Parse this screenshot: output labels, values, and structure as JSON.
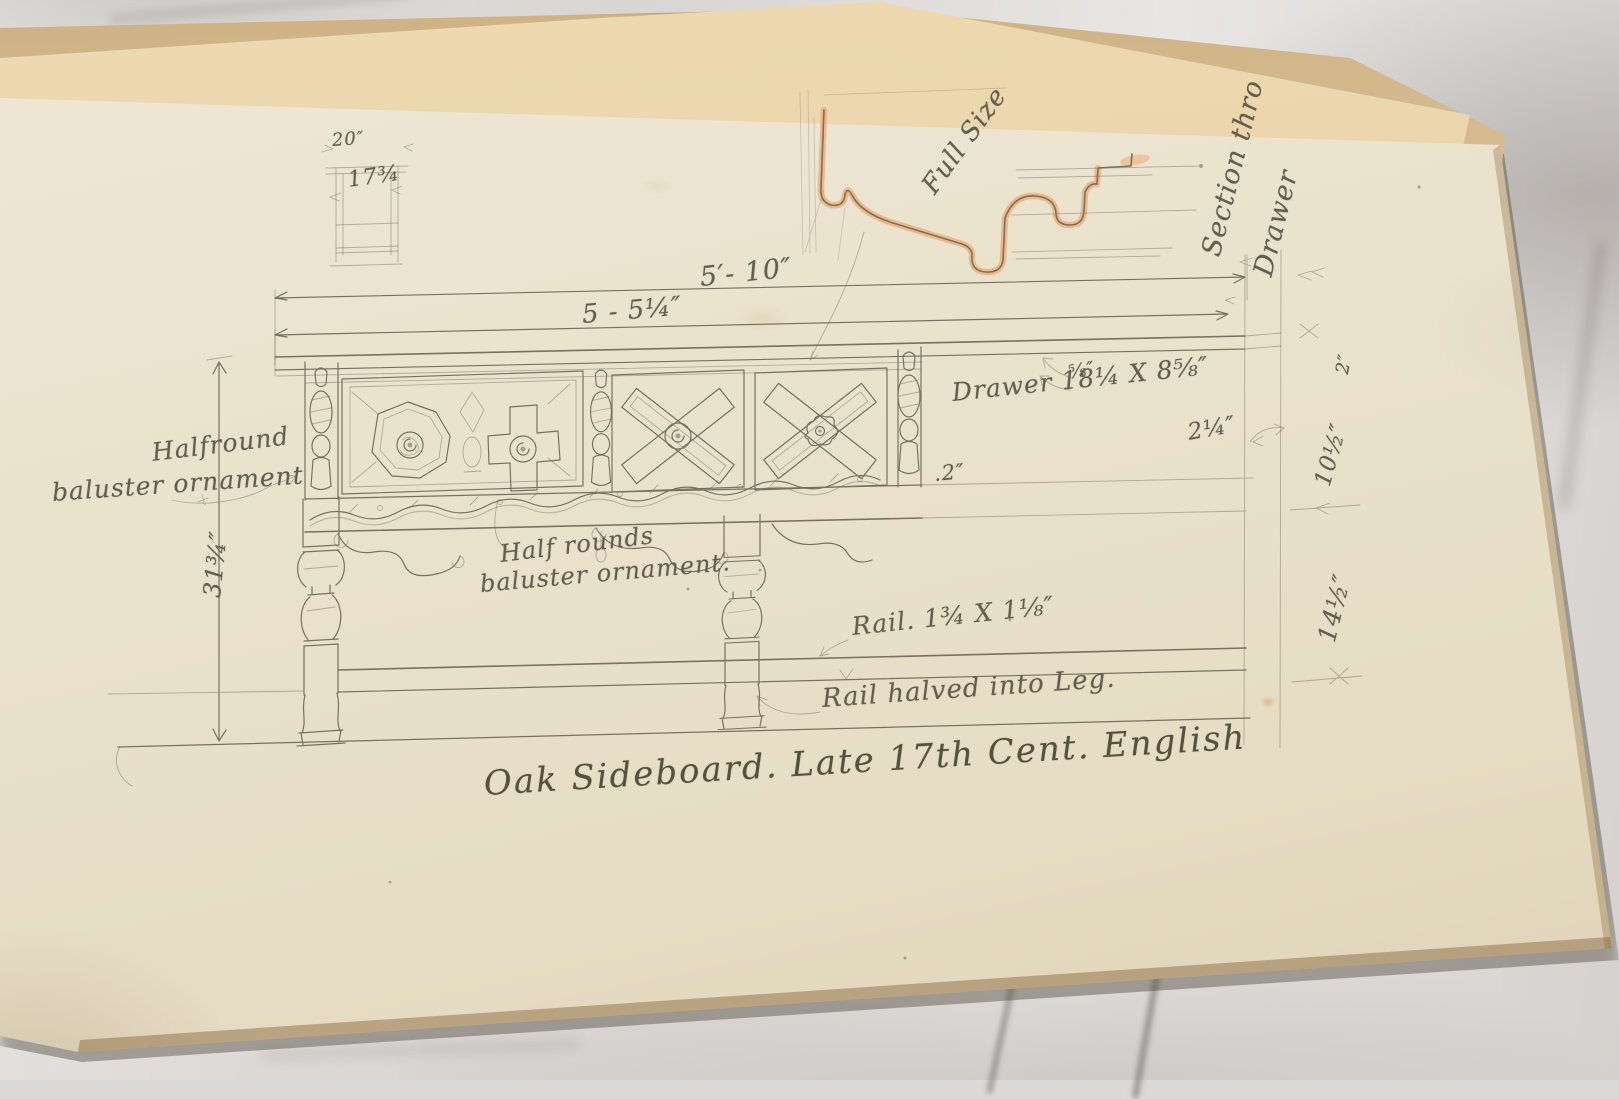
{
  "colors": {
    "pencil": "#79705f",
    "pencil_dark": "#5f574a",
    "highlight": "#eeab74",
    "paper": "#eae1cc",
    "cover": "#d5ba90",
    "sheet": "#e9d6ae",
    "marble": "#dcdad8",
    "page_edge": "#8a6a3c"
  },
  "page": {
    "title": "Oak Sideboard. Late 17th Cent. English",
    "end_view": {
      "width_dim": "20″",
      "height_dim": "17¾"
    },
    "detail_labels": {
      "full_size": "Full Size",
      "section_line1": "Section thro",
      "section_line2": "Drawer"
    },
    "dimensions": {
      "overall_width": "5′- 10″",
      "top_length": "5 - 5¼″",
      "top_thickness": "⅝″",
      "drawer_size": "Drawer 18¼ X 8⅝″",
      "gap": ".2″",
      "edge_offset": "2¼″",
      "edge_small": "2″",
      "drawer_depth": "10½″",
      "underframe_height": "14½″",
      "overall_height": "31¾″",
      "rail_size": "Rail. 1¾ X 1⅛″"
    },
    "annotations": {
      "halfround_line1": "Halfround",
      "halfround_line2": "baluster ornament",
      "halfrounds_line1": "Half rounds",
      "halfrounds_line2": "baluster ornament.",
      "rail_note": "Rail halved into Leg."
    }
  }
}
